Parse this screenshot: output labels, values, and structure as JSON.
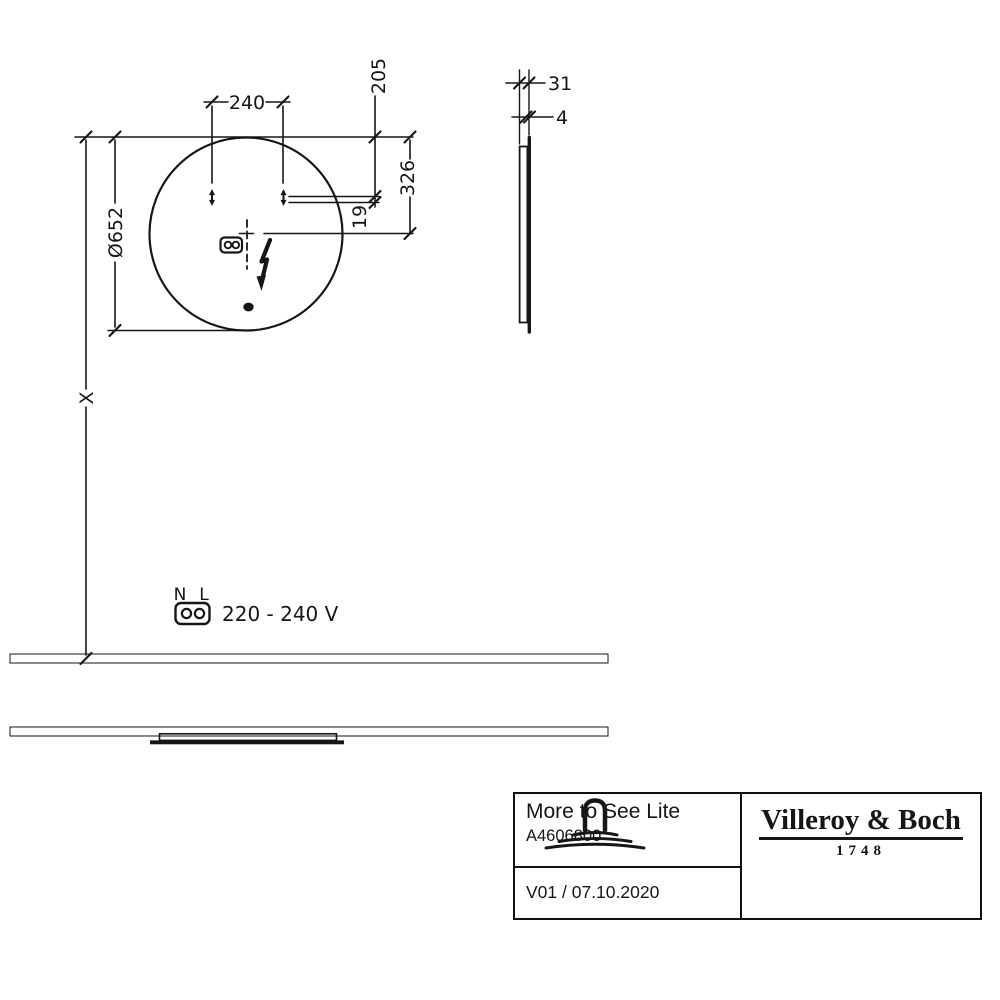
{
  "colors": {
    "ink": "#161616",
    "paper": "#ffffff"
  },
  "drawing": {
    "front_view": {
      "diameter": "Ø652",
      "hole_spacing": "240",
      "holes_from_top": "205",
      "center_from_top": "326",
      "cable_offset": "19",
      "mount_height": "X"
    },
    "side_view": {
      "depth": "31",
      "glass_thickness": "4"
    },
    "power": {
      "neutral": "N",
      "live": "L",
      "voltage": "220 - 240 V"
    }
  },
  "title_block": {
    "product_name": "More to See Lite",
    "article_number": "A4606800",
    "version_date": "V01 / 07.10.2020",
    "brand_name": "Villeroy & Boch",
    "brand_year": "1748"
  }
}
